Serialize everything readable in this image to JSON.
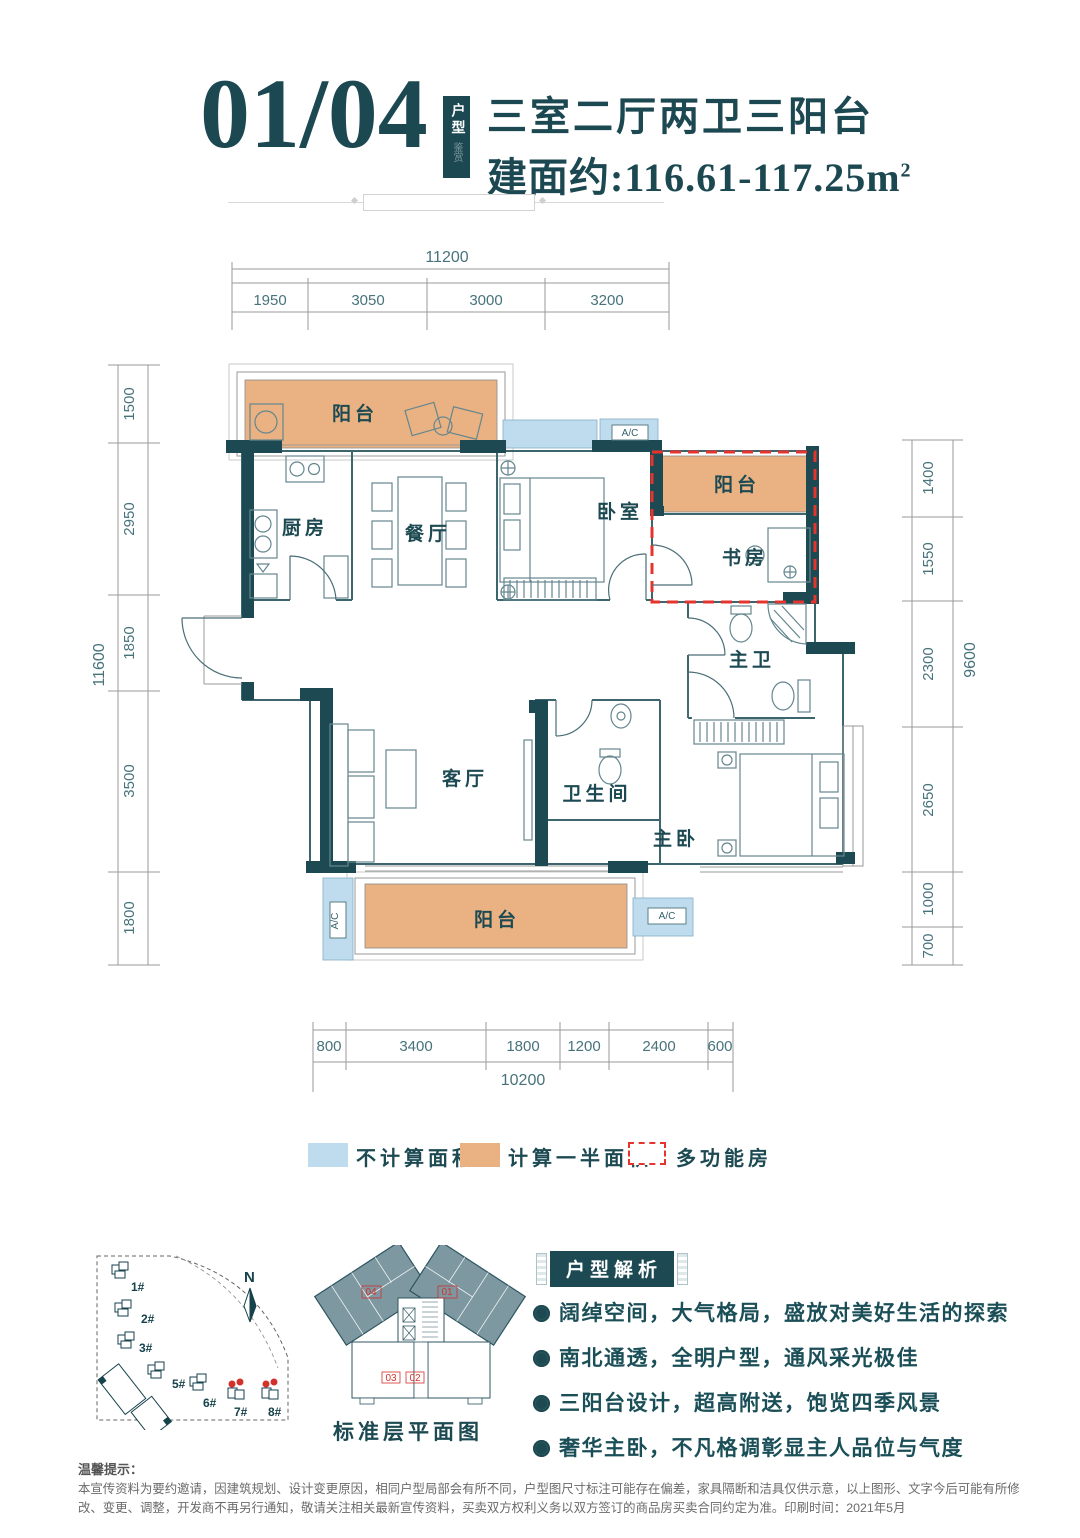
{
  "header": {
    "unit_code": "01/04",
    "badge": "户型",
    "badge_sub": "鉴赏",
    "title": "三室二厅两卫三阳台",
    "area": "建面约:116.61-117.25m",
    "area_sup": "2"
  },
  "dims": {
    "top": {
      "total": "11200",
      "segments": [
        "1950",
        "3050",
        "3000",
        "3200"
      ]
    },
    "left": {
      "total": "11600",
      "segments": [
        "1500",
        "2950",
        "1850",
        "3500",
        "1800"
      ]
    },
    "right": {
      "total": "9600",
      "segments": [
        "1400",
        "1550",
        "2300",
        "2650",
        "1000",
        "700"
      ]
    },
    "bottom": {
      "total": "10200",
      "segments": [
        "800",
        "3400",
        "1800",
        "1200",
        "2400",
        "600"
      ]
    }
  },
  "rooms": {
    "balcony": "阳台",
    "kitchen": "厨房",
    "dining": "餐厅",
    "bedroom": "卧室",
    "study": "书房",
    "master_bath": "主卫",
    "bath": "卫生间",
    "living": "客厅",
    "master_bedroom": "主卧",
    "ac": "A/C"
  },
  "legend": {
    "no_area": "不计算面积",
    "half_area": "计算一半面积",
    "multi_room": "多功能房"
  },
  "site_plan": {
    "north": "N",
    "buildings": [
      "1#",
      "2#",
      "3#",
      "5#",
      "6#",
      "7#",
      "8#"
    ]
  },
  "standard_floor": {
    "title": "标准层平面图",
    "units": {
      "top_left": "04",
      "top_right": "01",
      "bottom_left": "03",
      "bottom_right": "02"
    }
  },
  "analysis": {
    "title": "户型解析",
    "items": [
      "阔绰空间，大气格局，盛放对美好生活的探索",
      "南北通透，全明户型，通风采光极佳",
      "三阳台设计，超高附送，饱览四季风景",
      "奢华主卧，不凡格调彰显主人品位与气度"
    ]
  },
  "disclaimer": {
    "title": "温馨提示：",
    "body": "本宣传资料为要约邀请，因建筑规划、设计变更原因，相同户型局部会有所不同，户型图尺寸标注可能存在偏差，家具隔断和洁具仅供示意，以上图形、文字今后可能有所修改、变更、调整，开发商不再另行通知，敬请关注相关最新宣传资料，买卖双方权利义务以双方签订的商品房买卖合同约定为准。印刷时间：2021年5月"
  },
  "colors": {
    "teal": "#1d4a52",
    "orange": "#eab282",
    "blue": "#bfdcee",
    "red": "#e5342e"
  }
}
